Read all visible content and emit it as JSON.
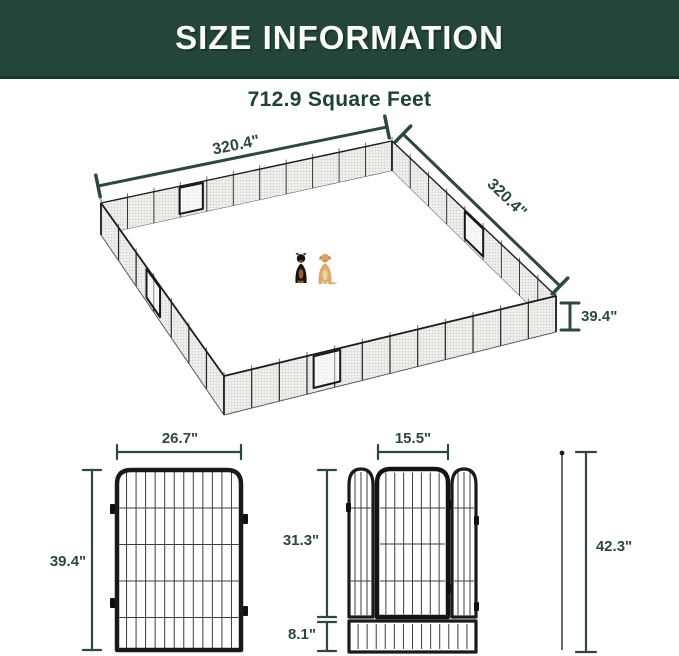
{
  "header": {
    "title": "SIZE INFORMATION"
  },
  "subtitle": "712.9 Square Feet",
  "pen": {
    "side_length_left": "320.4\"",
    "side_length_right": "320.4\"",
    "wall_height": "39.4\"",
    "dogs": [
      "rottweiler",
      "golden-retriever"
    ]
  },
  "panel": {
    "width": "26.7\"",
    "height": "39.4\""
  },
  "door_panel": {
    "door_width": "15.5\"",
    "door_height": "31.3\"",
    "bottom_bar_height": "8.1\"",
    "total_height_with_stake": "42.3\""
  },
  "colors": {
    "header_bg": "#23453a",
    "heading_text": "#1d4334",
    "dimension_lines": "#2c4a3b"
  }
}
